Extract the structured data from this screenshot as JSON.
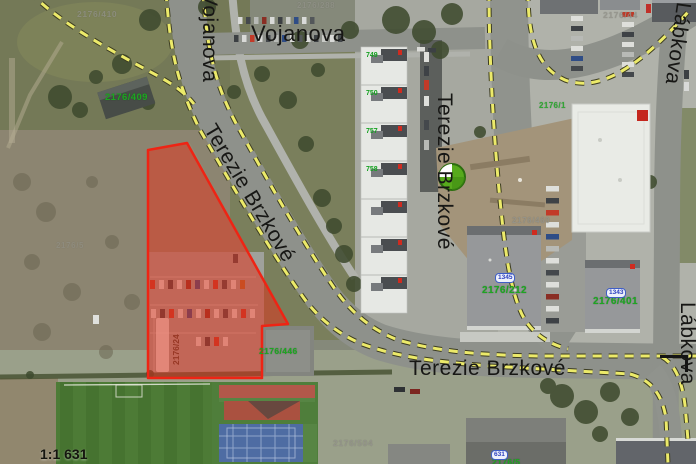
{
  "map": {
    "scale": "1:1 631",
    "streets": {
      "vojanova_horizontal": "Vojanova",
      "vojanova_vertical": "Vojanova",
      "terezie_brzkove_diagonal": "Terezie Brzkové",
      "terezie_brzkove_vertical": "Terezie Brzkové",
      "terezie_brzkove_horizontal": "Terezie Brzkové",
      "labkova_top": "Lábkova",
      "labkova_bottom": "Lábkova"
    },
    "parcel_labels": {
      "p2176_410": "2176/410",
      "p2176_288": "2176/288",
      "p2176_44": "2176/44",
      "p2176_460": "2176/460",
      "p2176_504": "2176/504",
      "p2176_5_left": "2176/5",
      "p2176_409": "2176/409",
      "p2176_1": "2176/1",
      "p2176_212": "2176/212",
      "p2176_401": "2176/401",
      "p2176_446": "2176/446",
      "p2176_5_bottom": "2176/5",
      "p2176_24": "2176/24"
    },
    "house_numbers": {
      "green": {
        "n749": "749",
        "n750": "750",
        "n757": "757",
        "n758": "758"
      },
      "blue": {
        "n1345": "1345",
        "n1343": "1343",
        "n631": "631"
      }
    },
    "icons": {
      "poi_marker": "green-circle-poi-marker",
      "corner_mark": "selection-corner-bracket"
    },
    "colors": {
      "highlight_fill": "#e23019",
      "highlight_stroke": "#ee2414",
      "boundary_dash": "#ecea6a",
      "parcel_green": "#1da621",
      "parcel_grey": "#90908a",
      "house_blue": "#2b3fbf"
    }
  }
}
